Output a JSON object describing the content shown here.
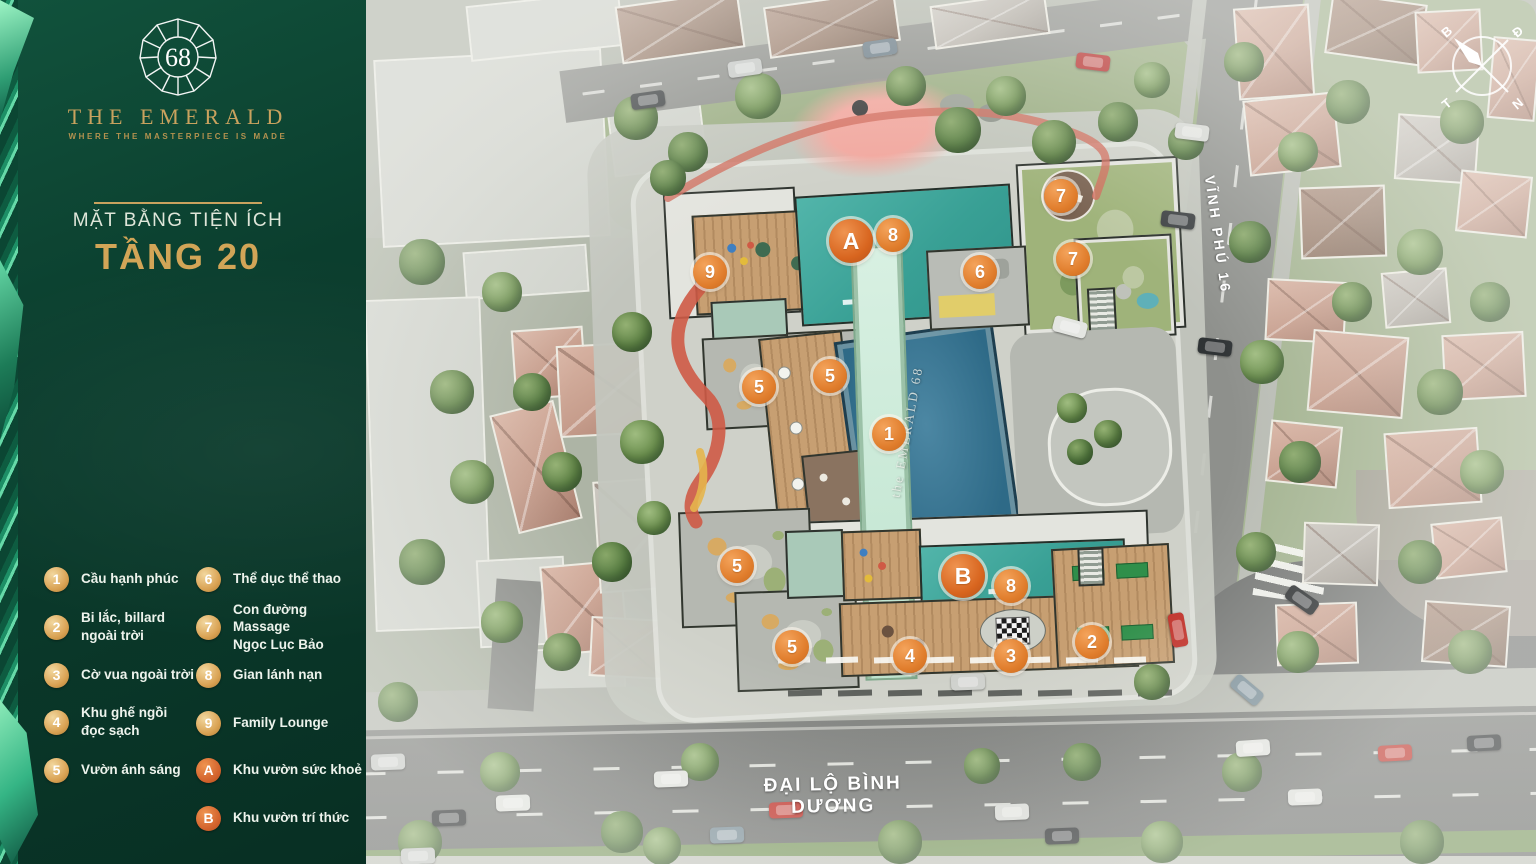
{
  "branding": {
    "logo_number": "68",
    "brand_name": "THE EMERALD",
    "tagline": "WHERE THE MASTERPIECE IS MADE",
    "plan_subtitle": "MẶT BẰNG TIỆN ÍCH",
    "plan_title": "TẦNG 20"
  },
  "legend": {
    "columns": [
      {
        "items": [
          {
            "badge": "1",
            "kind": "num",
            "label": "Cầu hạnh phúc"
          },
          {
            "badge": "2",
            "kind": "num",
            "label": "Bi lắc, billard\nngoài trời"
          },
          {
            "badge": "3",
            "kind": "num",
            "label": "Cờ vua ngoài trời"
          },
          {
            "badge": "4",
            "kind": "num",
            "label": "Khu ghế ngồi\nđọc sạch"
          },
          {
            "badge": "5",
            "kind": "num",
            "label": "Vườn ánh sáng"
          }
        ]
      },
      {
        "items": [
          {
            "badge": "6",
            "kind": "num",
            "label": "Thể dục thể thao"
          },
          {
            "badge": "7",
            "kind": "num",
            "label": "Con đường Massage\nNgọc Lục Bảo"
          },
          {
            "badge": "8",
            "kind": "num",
            "label": "Gian lánh nạn"
          },
          {
            "badge": "9",
            "kind": "num",
            "label": "Family Lounge"
          },
          {
            "badge": "A",
            "kind": "zone",
            "label": "Khu vườn sức khoẻ"
          },
          {
            "badge": "B",
            "kind": "zone",
            "label": "Khu vườn trí thức"
          }
        ]
      }
    ]
  },
  "map": {
    "roads": {
      "vertical": "VĨNH PHÚ 16",
      "horizontal": "ĐẠI LỘ BÌNH DƯƠNG"
    },
    "pool_label": "the EMERALD 68",
    "compass": {
      "top_left": "B",
      "top_right": "Đ",
      "bottom_left": "T",
      "bottom_right": "N"
    },
    "markers": [
      {
        "id": "9",
        "kind": "num",
        "x": 710,
        "y": 272
      },
      {
        "id": "A",
        "kind": "zone",
        "x": 851,
        "y": 241
      },
      {
        "id": "8",
        "kind": "num",
        "x": 893,
        "y": 235
      },
      {
        "id": "7",
        "kind": "num",
        "x": 1061,
        "y": 196
      },
      {
        "id": "6",
        "kind": "num",
        "x": 980,
        "y": 272
      },
      {
        "id": "7",
        "kind": "num",
        "x": 1073,
        "y": 259
      },
      {
        "id": "5",
        "kind": "num",
        "x": 759,
        "y": 387
      },
      {
        "id": "5",
        "kind": "num",
        "x": 830,
        "y": 376
      },
      {
        "id": "1",
        "kind": "num",
        "x": 889,
        "y": 434
      },
      {
        "id": "5",
        "kind": "num",
        "x": 737,
        "y": 566
      },
      {
        "id": "B",
        "kind": "zone",
        "x": 963,
        "y": 576
      },
      {
        "id": "8",
        "kind": "num",
        "x": 1011,
        "y": 586
      },
      {
        "id": "5",
        "kind": "num",
        "x": 792,
        "y": 647
      },
      {
        "id": "4",
        "kind": "num",
        "x": 910,
        "y": 656
      },
      {
        "id": "3",
        "kind": "num",
        "x": 1011,
        "y": 656
      },
      {
        "id": "2",
        "kind": "num",
        "x": 1092,
        "y": 642
      }
    ]
  },
  "colors": {
    "sidebar_green": "#0b3e2e",
    "brand_gold": "#c9a25e",
    "title_gold": "#d2a557",
    "legend_gold": "#d9a253",
    "zone_orange": "#d2622c",
    "marker_orange": "#e07d2c",
    "teal_roof": "#3aa99e",
    "pool_blue": "#2e6a87",
    "mint_bridge": "#cdeadc"
  }
}
